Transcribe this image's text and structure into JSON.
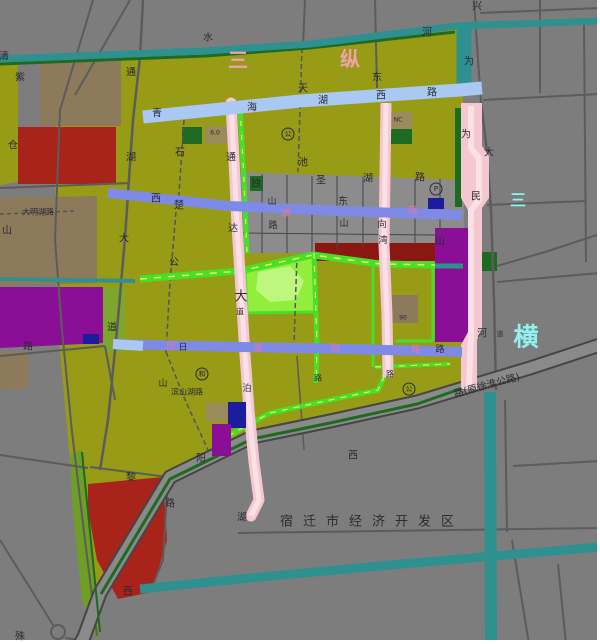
{
  "map": {
    "width": 600,
    "height": 644,
    "background": "#7d7d7d",
    "palette": {
      "d": "#2b2b33",
      "p": "#e8799c",
      "c": "#8ff2ef",
      "pk": "#f2a2ae",
      "teal": "#2f9090",
      "green": "#46e02b",
      "yellow": "#eef054",
      "pink": "#f5c7d1",
      "pinklight": "#fbe0e6",
      "blue": "#a9c8f3",
      "periwinkle": "#7e8ae6",
      "darkgreen": "#1d6b21"
    },
    "zones": [
      {
        "n": "olive-district",
        "c": "#979b16",
        "p": "55,62 205,54 310,45 458,27 463,92 463,385 417,402 330,421 252,437 170,477 100,593 88,637 82,560 70,460 58,330 55,238"
      },
      {
        "n": "olive-left-strip",
        "c": "#979b16",
        "p": "0,62 18,62 18,182 0,185"
      },
      {
        "n": "brown-block-1",
        "c": "#8c7a5a",
        "p": "40,57 121,57 121,126 40,126"
      },
      {
        "n": "red-block-1",
        "c": "#a8231a",
        "p": "18,127 116,127 116,184 18,184"
      },
      {
        "n": "brown-block-2",
        "c": "#8c7a5a",
        "p": "0,198 97,196 97,283 0,286"
      },
      {
        "n": "purple-block-1",
        "c": "#8b0f96",
        "p": "0,287 103,287 103,343 0,348"
      },
      {
        "n": "navy-block-1",
        "c": "#1c1c9e",
        "p": "83,334 99,334 99,344 83,344"
      },
      {
        "n": "brown-block-3",
        "c": "#8c7a5a",
        "p": "0,352 28,352 28,388 0,390"
      },
      {
        "n": "yellowgreen-strip",
        "c": "#7fa62c",
        "p": "103,288 125,288 125,352 103,352"
      },
      {
        "n": "gray-urban-blocks",
        "c": "#8c8c8c",
        "p": "237,172 464,180 464,228 435,228 435,243 315,243 315,253 237,253"
      },
      {
        "n": "darkred-strip",
        "c": "#8a1810",
        "p": "315,243 435,243 435,261 315,261"
      },
      {
        "n": "purple-block-2",
        "c": "#8b0f96",
        "p": "435,228 471,228 471,342 435,342"
      },
      {
        "n": "darkgreen-strip-river",
        "c": "#1d6b21",
        "p": "455,108 462,108 462,207 455,207"
      },
      {
        "n": "park",
        "c": "#92ee3d",
        "st": "#46e02b",
        "sw": 3,
        "p": "245,270 313,253 315,312 247,313"
      },
      {
        "n": "park-pond",
        "c": "#bdf77e",
        "p": "258,272 290,266 304,281 296,300 270,302 256,290"
      },
      {
        "n": "darkgreen-sq-1",
        "c": "#1d6b21",
        "p": "480,252 497,252 497,271 480,271"
      },
      {
        "n": "darkgreen-sq-2",
        "c": "#1d6b21",
        "p": "182,127 202,127 202,144 182,144"
      },
      {
        "n": "darkgreen-sq-3",
        "c": "#1d6b21",
        "p": "388,129 412,129 412,144 388,144"
      },
      {
        "n": "brown-sq-nc",
        "c": "#9b8a5a",
        "p": "385,112 412,112 412,129 385,129"
      },
      {
        "n": "brown-sq-60a",
        "c": "#9b8a5a",
        "p": "205,126 230,126 230,144 205,144"
      },
      {
        "n": "darkgreen-sq-4",
        "c": "#1d6b21",
        "p": "250,176 263,176 263,191 250,191"
      },
      {
        "n": "brown-block-90",
        "c": "#8c7a5a",
        "p": "388,295 418,295 418,323 388,323"
      },
      {
        "n": "red-block-2",
        "c": "#a8231a",
        "p": "88,484 163,477 167,540 152,592 118,599 97,560 88,510"
      },
      {
        "n": "green-strip-sw",
        "c": "#6f9e26",
        "p": "70,455 82,450 100,630 97,640 82,600 72,500"
      }
    ],
    "zones2": [
      {
        "n": "brown-sq-60b",
        "c": "#9b8a5a",
        "p": "206,403 228,403 228,421 206,421"
      },
      {
        "n": "navy-block-2",
        "c": "#1c1c9e",
        "p": "228,402 246,402 246,428 228,428"
      },
      {
        "n": "purple-block-3",
        "c": "#8b0f96",
        "p": "212,424 231,424 231,456 212,456"
      },
      {
        "n": "navy-block-3",
        "c": "#1c1c9e",
        "p": "428,198 444,198 444,209 428,209"
      },
      {
        "n": "border-right",
        "c": "#ffffff",
        "p": "597,0 600,0 600,644 597,644"
      },
      {
        "n": "border-bottom",
        "c": "#ffffff",
        "p": "0,640 600,640 600,644 0,644"
      }
    ],
    "lines": [
      {
        "n": "road-minor",
        "p": "93,0 60,110 55,240 62,330 72,432 85,540 97,636",
        "w": 2,
        "c": "#5c5c5c"
      },
      {
        "n": "road-minor",
        "p": "130,0 75,95",
        "w": 2,
        "c": "#5c5c5c"
      },
      {
        "n": "road-tonghu-avenue",
        "p": "143,0 140,57 133,120 125,238 117,330 108,420 100,470",
        "w": 2.5,
        "c": "#5c5c5c"
      },
      {
        "n": "road-minor-dashed",
        "p": "184,120 178,208",
        "w": 1.5,
        "c": "#55555c",
        "dash": "5,3"
      },
      {
        "n": "road-dagong",
        "p": "176,212 170,282 166,352",
        "w": 1.5,
        "c": "#55555c",
        "dash": "5,3"
      },
      {
        "n": "road-binshanhu",
        "p": "166,352 186,402 208,450",
        "w": 1.5,
        "c": "#55555c",
        "dash": "5,3"
      },
      {
        "n": "road-minor",
        "p": "305,0 303,46",
        "w": 2,
        "c": "#5c5c5c"
      },
      {
        "n": "road-tianchi",
        "p": "302,48 298,172",
        "w": 1.5,
        "c": "#55555c",
        "dash": "5,3"
      },
      {
        "n": "road-minor-dashed",
        "p": "297,255 294,344",
        "w": 1.5,
        "c": "#55555c",
        "dash": "5,3"
      },
      {
        "n": "road-minor",
        "p": "297,356 304,450",
        "w": 1.5,
        "c": "#5c5c5c"
      },
      {
        "n": "road-minor",
        "p": "375,0 377,88",
        "w": 2,
        "c": "#5c5c5c"
      },
      {
        "n": "road-xing",
        "p": "474,0 478,60 481,102",
        "w": 2,
        "c": "#5c5c5c"
      },
      {
        "n": "road-da",
        "p": "481,102 487,152 491,210 494,300 496,390",
        "w": 2.5,
        "c": "#5c5c5c"
      },
      {
        "n": "road-minor",
        "p": "540,0 540,93",
        "w": 2,
        "c": "#5c5c5c"
      },
      {
        "n": "road-minor",
        "p": "584,24 586,262",
        "w": 2,
        "c": "#5c5c5c"
      },
      {
        "n": "road-minor",
        "p": "483,100 600,94",
        "w": 2,
        "c": "#5c5c5c"
      },
      {
        "n": "road-minor",
        "p": "487,205 586,201",
        "w": 2,
        "c": "#5c5c5c"
      },
      {
        "n": "road-minor",
        "p": "497,266 545,252 600,234",
        "w": 2,
        "c": "#5c5c5c"
      },
      {
        "n": "road-minor",
        "p": "497,282 600,273",
        "w": 2,
        "c": "#5c5c5c"
      },
      {
        "n": "road-minor",
        "p": "480,13 600,8",
        "w": 2,
        "c": "#5c5c5c"
      },
      {
        "n": "road-minor",
        "p": "0,188 130,183",
        "w": 2,
        "c": "#5c5c5c"
      },
      {
        "n": "road-damignhu",
        "p": "0,214 75,211",
        "w": 1.5,
        "c": "#55555c",
        "dash": "4,3"
      },
      {
        "n": "road-minor",
        "p": "0,356 105,346",
        "w": 2,
        "c": "#5c5c5c"
      },
      {
        "n": "road-minor",
        "p": "105,346 115,400",
        "w": 2,
        "c": "#5c5c5c"
      },
      {
        "n": "road-minor",
        "p": "0,455 88,468",
        "w": 2,
        "c": "#5c5c5c"
      },
      {
        "n": "road-minor",
        "p": "0,540 55,628",
        "w": 2,
        "c": "#5c5c5c"
      },
      {
        "n": "road-minor",
        "p": "65,638 110,644",
        "w": 2,
        "c": "#5c5c5c"
      },
      {
        "n": "road-minor",
        "p": "238,533 600,528",
        "w": 2,
        "c": "#5c5c5c"
      },
      {
        "n": "road-minor",
        "p": "505,400 507,532",
        "w": 2,
        "c": "#5c5c5c"
      },
      {
        "n": "road-minor",
        "p": "512,540 529,644",
        "w": 2,
        "c": "#5c5c5c"
      },
      {
        "n": "road-minor",
        "p": "558,564 566,644",
        "w": 2,
        "c": "#5c5c5c"
      },
      {
        "n": "road-minor",
        "p": "513,466 600,461",
        "w": 2,
        "c": "#5c5c5c"
      },
      {
        "n": "road-minor",
        "p": "90,467 168,477",
        "w": 2,
        "c": "#5c5c5c"
      },
      {
        "n": "road-minor",
        "p": "168,477 163,560 150,592",
        "w": 2,
        "c": "#5c5c5c"
      },
      {
        "n": "block-grid",
        "p": "262,174 262,253",
        "w": 1,
        "c": "#44444c"
      },
      {
        "n": "block-grid",
        "p": "287,175 287,253",
        "w": 1,
        "c": "#44444c"
      },
      {
        "n": "block-grid",
        "p": "312,176 312,253",
        "w": 1,
        "c": "#44444c"
      },
      {
        "n": "block-grid",
        "p": "337,176 337,250",
        "w": 1,
        "c": "#44444c"
      },
      {
        "n": "block-grid",
        "p": "363,177 363,247",
        "w": 1,
        "c": "#44444c"
      },
      {
        "n": "block-grid",
        "p": "415,179 415,243",
        "w": 1,
        "c": "#44444c"
      },
      {
        "n": "block-grid",
        "p": "440,179 440,243",
        "w": 1,
        "c": "#44444c"
      },
      {
        "n": "block-grid",
        "p": "237,233 435,235",
        "w": 1,
        "c": "#44444c"
      },
      {
        "n": "highway-xuhuai",
        "p": "600,345 530,368 470,386 417,402 330,421 252,437 170,477 100,593 84,637 80,644",
        "w": 11,
        "c": "#8a8a8a",
        "case": "#454545",
        "cw": 15
      },
      {
        "n": "darkgreen-edge-boundary",
        "p": "463,388 417,404 330,423 252,439 170,479 101,594",
        "w": 3,
        "c": "#1d6b21"
      },
      {
        "n": "darkgreen-edge-sw",
        "p": "82,452 100,632",
        "w": 2,
        "c": "#1d6b21"
      },
      {
        "n": "darkgreen-riverbank",
        "p": "0,64 205,56 310,48 455,32",
        "w": 3,
        "c": "#1d6b21"
      },
      {
        "n": "green-road-1",
        "p": "140,279 240,271 313,255 380,264 435,265",
        "w": 7,
        "c": "#46e02b",
        "mid": "#eef054",
        "mw": 1.5,
        "mdash": "7,7"
      },
      {
        "n": "green-road-2",
        "p": "314,253 317,345 316,383",
        "w": 5,
        "c": "#46e02b",
        "mid": "#eef054",
        "mw": 1.2,
        "mdash": "6,7"
      },
      {
        "n": "green-road-3",
        "p": "373,267 373,367",
        "w": 3,
        "c": "#46e02b"
      },
      {
        "n": "green-road-4",
        "p": "433,267 433,341",
        "w": 3,
        "c": "#46e02b"
      },
      {
        "n": "green-road-5",
        "p": "396,341 433,341",
        "w": 3,
        "c": "#46e02b"
      },
      {
        "n": "green-road-6",
        "p": "375,367 450,364",
        "w": 4,
        "c": "#46e02b",
        "mid": "#eef054",
        "mw": 1.2,
        "mdash": "6,6"
      },
      {
        "n": "green-road-7",
        "p": "228,436 270,413 330,400 378,390 386,373",
        "w": 5,
        "c": "#46e02b",
        "mid": "#eef054",
        "mw": 1.2,
        "mdash": "6,6"
      },
      {
        "n": "river-top",
        "p": "0,59 205,51 310,44 457,26 600,21",
        "w": 7,
        "c": "#2f9090"
      },
      {
        "n": "river-vertical-ne",
        "p": "464,27 464,90",
        "w": 15,
        "c": "#2f9090"
      },
      {
        "n": "river-small-west",
        "p": "0,279 135,281",
        "w": 4,
        "c": "#2f9090"
      },
      {
        "n": "river-small-mid",
        "p": "435,266 463,266",
        "w": 5,
        "c": "#2f9090"
      },
      {
        "n": "river-bottom",
        "p": "140,589 250,578 390,565 600,547",
        "w": 9,
        "c": "#2f9090"
      },
      {
        "n": "river-weimin-south",
        "p": "490,392 491,644",
        "w": 12,
        "c": "#2f9090"
      },
      {
        "n": "pink-road-tongda",
        "p": "231,103 234,160 237,225 241,290 245,355 249,410 254,462 259,500 251,516",
        "w": 11,
        "c": "#f5c7d1",
        "cap": "round",
        "mid": "#fbe0e6",
        "mw": 5
      },
      {
        "n": "green-strip-tongda",
        "p": "240,107 244,180 247,253",
        "w": 5,
        "c": "#46e02b",
        "mid": "#eef054",
        "mw": 1.2,
        "mdash": "5,9"
      },
      {
        "n": "pink-road-mid",
        "p": "386,103 385,175 384,245 387,315 388,377",
        "w": 11,
        "c": "#f5c7d1",
        "mid": "#fbe0e6",
        "mw": 5
      },
      {
        "n": "pink-weimin-river",
        "poly": true,
        "p": "461,103 482,103 482,146 489,156 489,198 482,208 482,328 477,340 477,389 461,389 461,345 468,332 468,210 461,198",
        "c": "#f5c7d1"
      },
      {
        "n": "pink-weimin-inner",
        "p": "471,106 471,148 479,158 479,200 471,210 471,334 469,386",
        "w": 6,
        "c": "#fbe0e6"
      },
      {
        "n": "blue-road-xichu",
        "p": "108,193 230,206 340,211 462,215",
        "w": 10,
        "c": "#7e8ae6"
      },
      {
        "n": "blue-road-south",
        "p": "113,344 240,347 350,349 462,352",
        "w": 10,
        "c": "#7e8ae6"
      },
      {
        "n": "blue-road-south-tip",
        "p": "113,344 143,346",
        "w": 10,
        "c": "#a9c8f3"
      },
      {
        "n": "blue-road-qinghaihu",
        "p": "143,117 300,101 460,90 482,88",
        "w": 13,
        "c": "#a9c8f3"
      }
    ],
    "circles": [
      {
        "n": "roundabout",
        "x": 58,
        "y": 632,
        "r": 7,
        "c": "#5c5c5c"
      }
    ],
    "labels": [
      {
        "t": "水",
        "x": 208,
        "y": 38
      },
      {
        "t": "河",
        "x": 427,
        "y": 33
      },
      {
        "t": "兴",
        "x": 477,
        "y": 7
      },
      {
        "t": "为",
        "x": 469,
        "y": 62
      },
      {
        "t": "清",
        "x": 4,
        "y": 57
      },
      {
        "t": "紫",
        "x": 20,
        "y": 78
      },
      {
        "t": "通",
        "x": 131,
        "y": 73
      },
      {
        "t": "仓",
        "x": 13,
        "y": 146
      },
      {
        "t": "湖",
        "x": 131,
        "y": 158
      },
      {
        "t": "石",
        "x": 180,
        "y": 153
      },
      {
        "t": "东",
        "x": 377,
        "y": 78
      },
      {
        "t": "青",
        "x": 157,
        "y": 114
      },
      {
        "t": "海",
        "x": 252,
        "y": 108
      },
      {
        "t": "天",
        "x": 303,
        "y": 89
      },
      {
        "t": "湖",
        "x": 323,
        "y": 101
      },
      {
        "t": "西",
        "x": 381,
        "y": 96
      },
      {
        "t": "路",
        "x": 432,
        "y": 93
      },
      {
        "t": "6.0",
        "x": 215,
        "y": 133,
        "s": 6
      },
      {
        "t": "NC",
        "x": 398,
        "y": 120,
        "s": 6
      },
      {
        "t": "90",
        "x": 403,
        "y": 318,
        "s": 6
      },
      {
        "t": "通",
        "x": 231,
        "y": 158
      },
      {
        "t": "达",
        "x": 233,
        "y": 229
      },
      {
        "t": "大",
        "x": 241,
        "y": 297,
        "s": 13
      },
      {
        "t": "道",
        "x": 240,
        "y": 312,
        "s": 8
      },
      {
        "t": "泊",
        "x": 247,
        "y": 389,
        "s": 9
      },
      {
        "t": "湖",
        "x": 242,
        "y": 518
      },
      {
        "t": "大",
        "x": 124,
        "y": 239
      },
      {
        "t": "道",
        "x": 112,
        "y": 328
      },
      {
        "t": "山",
        "x": 7,
        "y": 231
      },
      {
        "t": "路",
        "x": 28,
        "y": 347
      },
      {
        "t": "大明湖路",
        "x": 38,
        "y": 212,
        "s": 8
      },
      {
        "t": "西",
        "x": 156,
        "y": 199
      },
      {
        "t": "楚",
        "x": 179,
        "y": 206
      },
      {
        "t": "独",
        "x": 256,
        "y": 184
      },
      {
        "t": "山",
        "x": 272,
        "y": 202,
        "s": 9
      },
      {
        "t": "路",
        "x": 273,
        "y": 226,
        "s": 9
      },
      {
        "t": "湖",
        "x": 286,
        "y": 214,
        "c": "p",
        "s": 9
      },
      {
        "t": "圣",
        "x": 321,
        "y": 181
      },
      {
        "t": "东",
        "x": 343,
        "y": 202
      },
      {
        "t": "山",
        "x": 344,
        "y": 224,
        "s": 9
      },
      {
        "t": "湖",
        "x": 368,
        "y": 179
      },
      {
        "t": "路",
        "x": 420,
        "y": 178
      },
      {
        "t": "路",
        "x": 413,
        "y": 211,
        "c": "p",
        "s": 9
      },
      {
        "t": "池",
        "x": 303,
        "y": 163
      },
      {
        "t": "向",
        "x": 382,
        "y": 225,
        "s": 9
      },
      {
        "t": "湾",
        "x": 383,
        "y": 241,
        "s": 9
      },
      {
        "t": "为",
        "x": 466,
        "y": 135
      },
      {
        "t": "民",
        "x": 476,
        "y": 197
      },
      {
        "t": "河",
        "x": 482,
        "y": 334
      },
      {
        "t": "道",
        "x": 500,
        "y": 334,
        "s": 7
      },
      {
        "t": "大",
        "x": 489,
        "y": 153
      },
      {
        "t": "公",
        "x": 174,
        "y": 263
      },
      {
        "t": "阳",
        "x": 171,
        "y": 347,
        "c": "p",
        "s": 9
      },
      {
        "t": "日",
        "x": 183,
        "y": 348,
        "s": 9
      },
      {
        "t": "湖",
        "x": 258,
        "y": 349,
        "c": "p",
        "s": 9
      },
      {
        "t": "阳",
        "x": 335,
        "y": 349,
        "c": "p",
        "s": 9
      },
      {
        "t": "路",
        "x": 416,
        "y": 350,
        "c": "p",
        "s": 9
      },
      {
        "t": "路",
        "x": 440,
        "y": 350,
        "s": 9
      },
      {
        "t": "山",
        "x": 163,
        "y": 384,
        "s": 9
      },
      {
        "t": "滨山湖路",
        "x": 187,
        "y": 392,
        "s": 8
      },
      {
        "t": "阳",
        "x": 201,
        "y": 459
      },
      {
        "t": "山",
        "x": 440,
        "y": 242
      },
      {
        "t": "黎",
        "x": 131,
        "y": 478
      },
      {
        "t": "路",
        "x": 170,
        "y": 504
      },
      {
        "t": "西",
        "x": 128,
        "y": 592
      },
      {
        "t": "殊",
        "x": 20,
        "y": 637
      },
      {
        "t": "西",
        "x": 353,
        "y": 456
      },
      {
        "t": "路",
        "x": 318,
        "y": 378,
        "s": 8
      },
      {
        "t": "路",
        "x": 390,
        "y": 374,
        "s": 8
      },
      {
        "t": "路(原徐淮公路)",
        "x": 487,
        "y": 386,
        "r": -15,
        "s": 10
      },
      {
        "t": "宿迁市经济开发区",
        "x": 372,
        "y": 522,
        "s": 13,
        "ls": 10
      },
      {
        "t": "三",
        "x": 238,
        "y": 60,
        "c": "pk",
        "s": 20,
        "b": 1
      },
      {
        "t": "纵",
        "x": 350,
        "y": 59,
        "c": "pk",
        "s": 20,
        "b": 1
      },
      {
        "t": "三",
        "x": 518,
        "y": 200,
        "c": "c",
        "s": 16,
        "b": 1
      },
      {
        "t": "横",
        "x": 526,
        "y": 337,
        "c": "c",
        "s": 25,
        "b": 1
      }
    ],
    "circled": [
      {
        "t": "公",
        "x": 288,
        "y": 134
      },
      {
        "t": "P",
        "x": 436,
        "y": 189
      },
      {
        "t": "和",
        "x": 202,
        "y": 374
      },
      {
        "t": "公",
        "x": 409,
        "y": 389
      }
    ]
  }
}
